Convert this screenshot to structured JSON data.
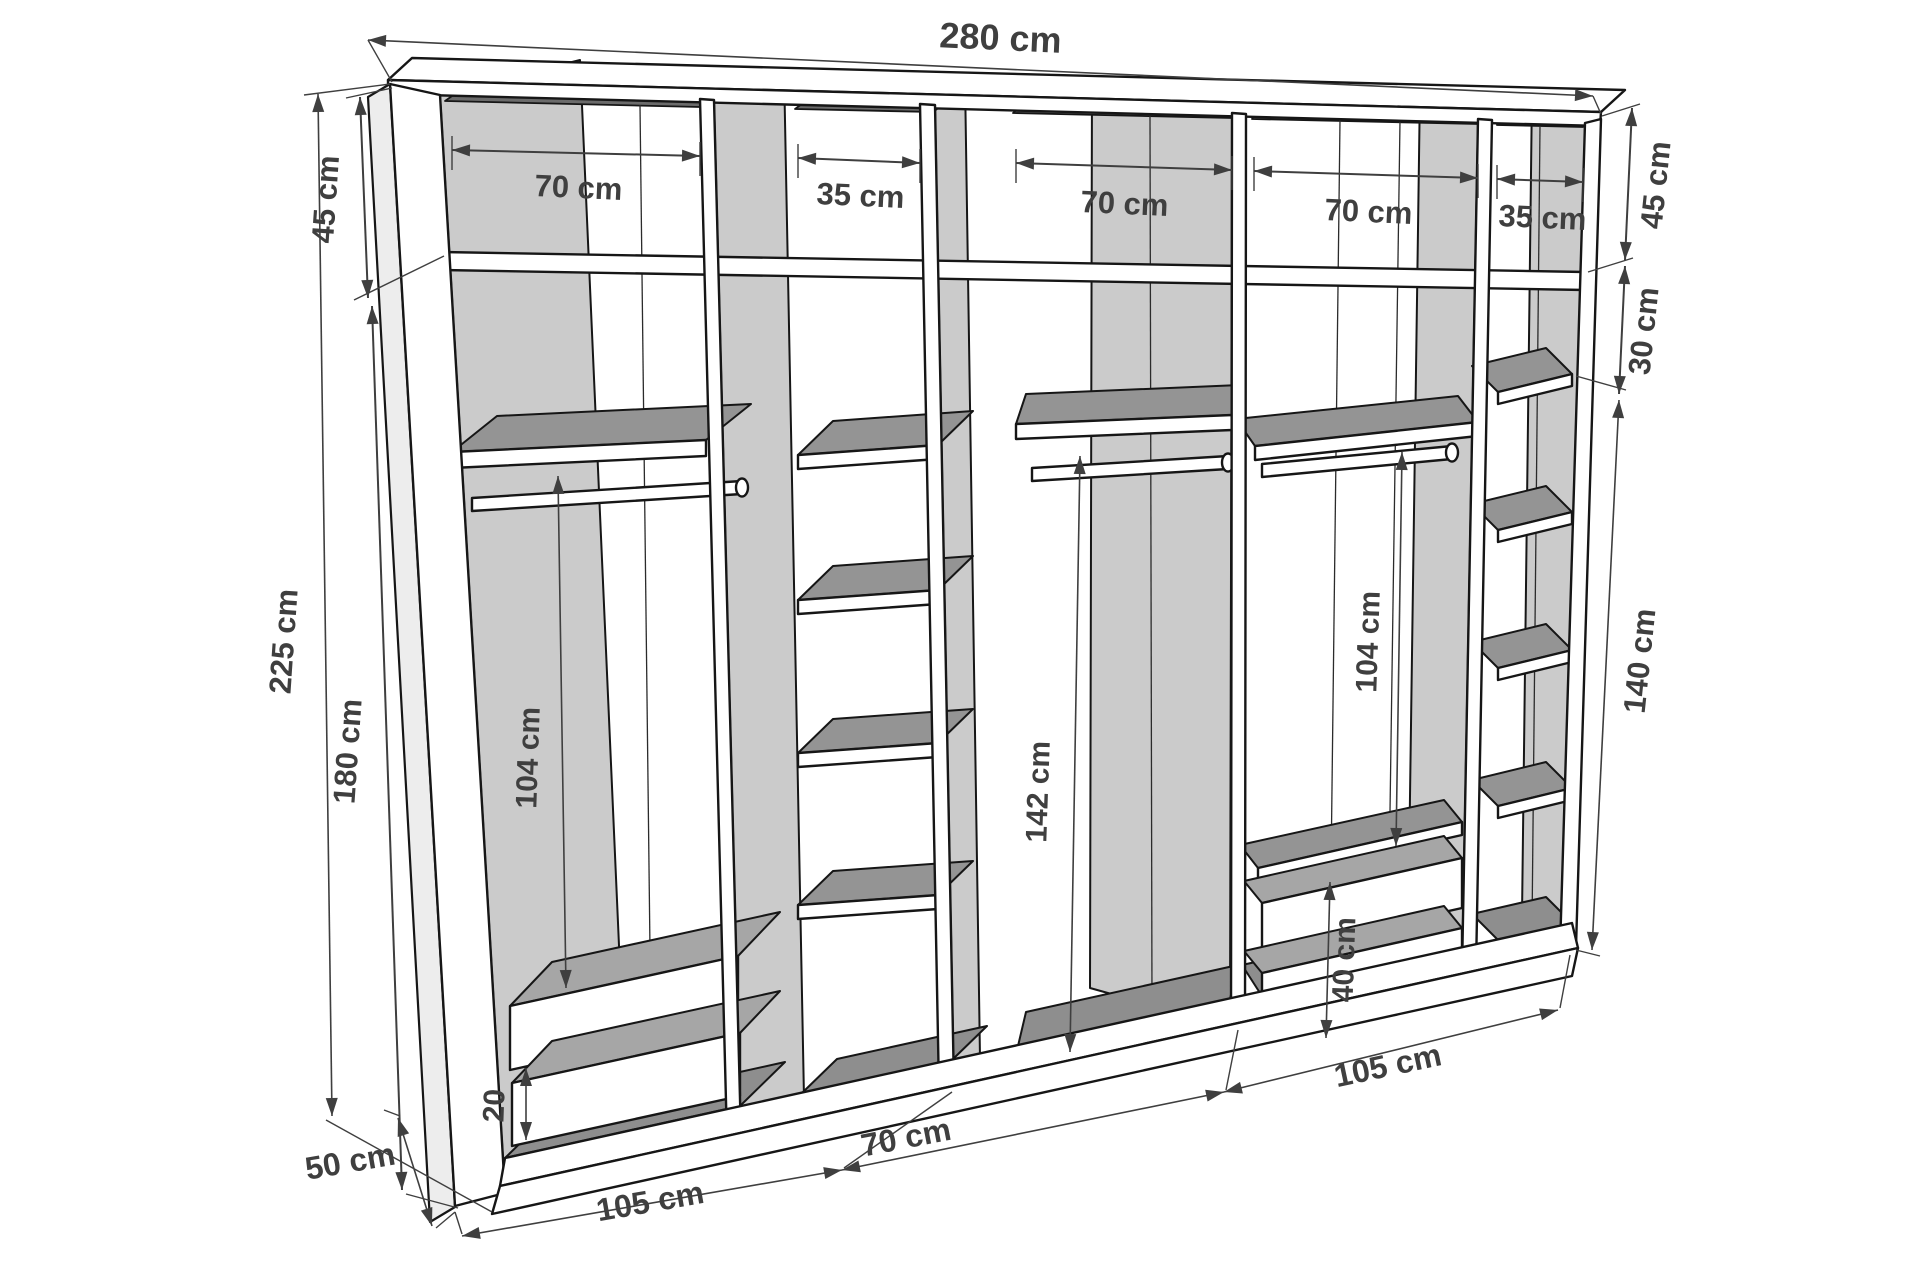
{
  "diagram": {
    "kind": "wardrobe-interior-dimension-drawing",
    "unit": "cm",
    "dims": {
      "total_width": "280 cm",
      "top_bays": [
        "70 cm",
        "35 cm",
        "70 cm",
        "70 cm",
        "35 cm"
      ],
      "total_height": "225 cm",
      "left_top_height": "45 cm",
      "left_lower_height": "180 cm",
      "right_top_height": "45 cm",
      "right_gap": "30 cm",
      "right_column": "140 cm",
      "bay1_hang": "104 cm",
      "bay3_hang": "142 cm",
      "bay4_hang": "104 cm",
      "bay4_drawers": "40 cm",
      "bay1_drawer": "20",
      "bottom_spans": [
        "105 cm",
        "70 cm",
        "105 cm"
      ],
      "depth": "50 cm"
    }
  }
}
